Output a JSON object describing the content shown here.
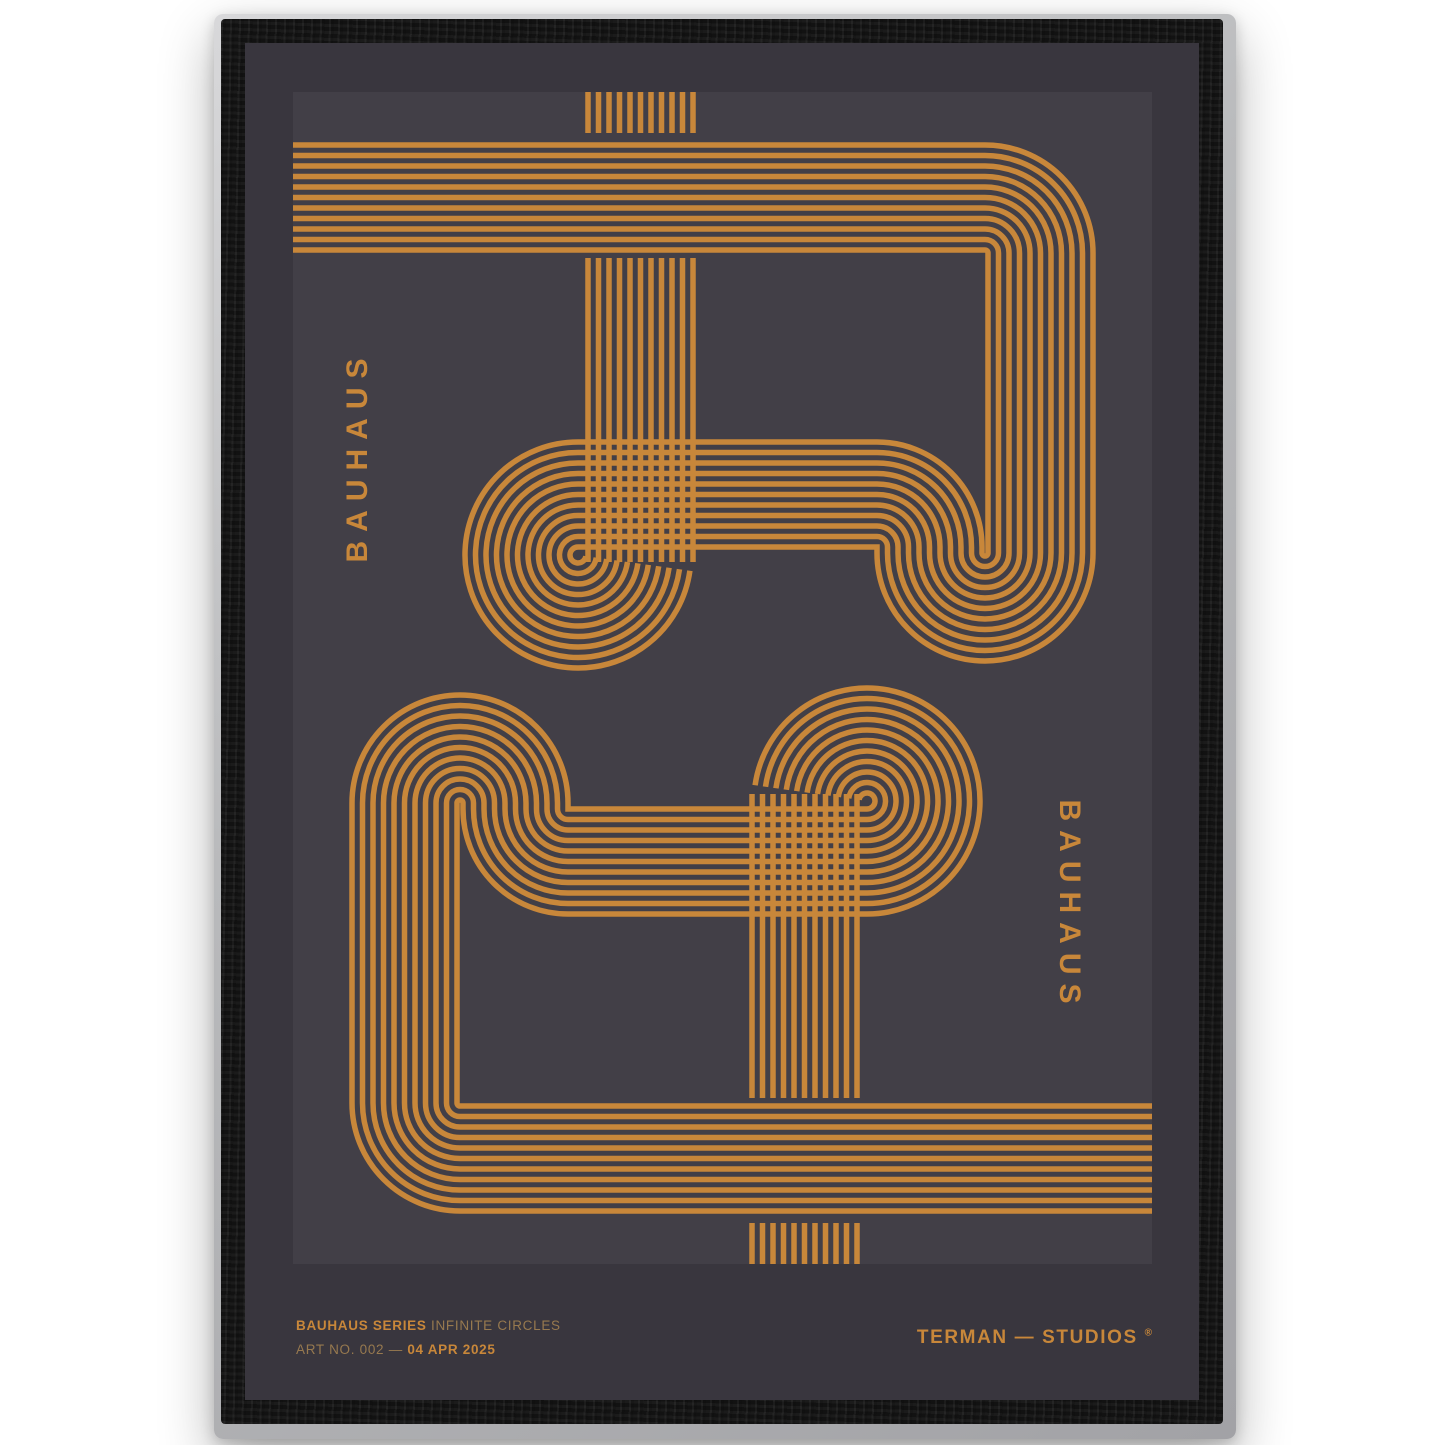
{
  "page": {
    "background_color": "#ffffff"
  },
  "frame": {
    "material": "black-wood",
    "wood_color": "#141414",
    "edge_plate_color": "#b9babc"
  },
  "poster": {
    "bg_color": "#39363E",
    "art_bg_color": "#423F47",
    "accent_color": "#C8873A",
    "muted_text_color": "#97794F",
    "left_vertical_label": "BAUHAUS",
    "right_vertical_label": "BAUHAUS",
    "footer": {
      "series_bold": "BAUHAUS SERIES",
      "series_regular": " INFINITE CIRCLES",
      "artno_regular": "ART NO. 002 — ",
      "artno_bold": "04 APR 2025",
      "studio": "TERMAN — STUDIOS ",
      "reg_mark": "®"
    },
    "artwork": {
      "name": "infinite-circles-line-art",
      "description": "Striped orange band motif: top band flush left, corner down, 270-degree loop-back into a horizontal band ending in a ~262-degree spiral coil, plus detached stripe combs; duplicated with 180-degree rotation for the lower half.",
      "stripes_per_band": 11,
      "stripe_color": "#C8873A",
      "stripe_width_px": 5.5,
      "stripe_pitch_px": 10.5
    }
  }
}
